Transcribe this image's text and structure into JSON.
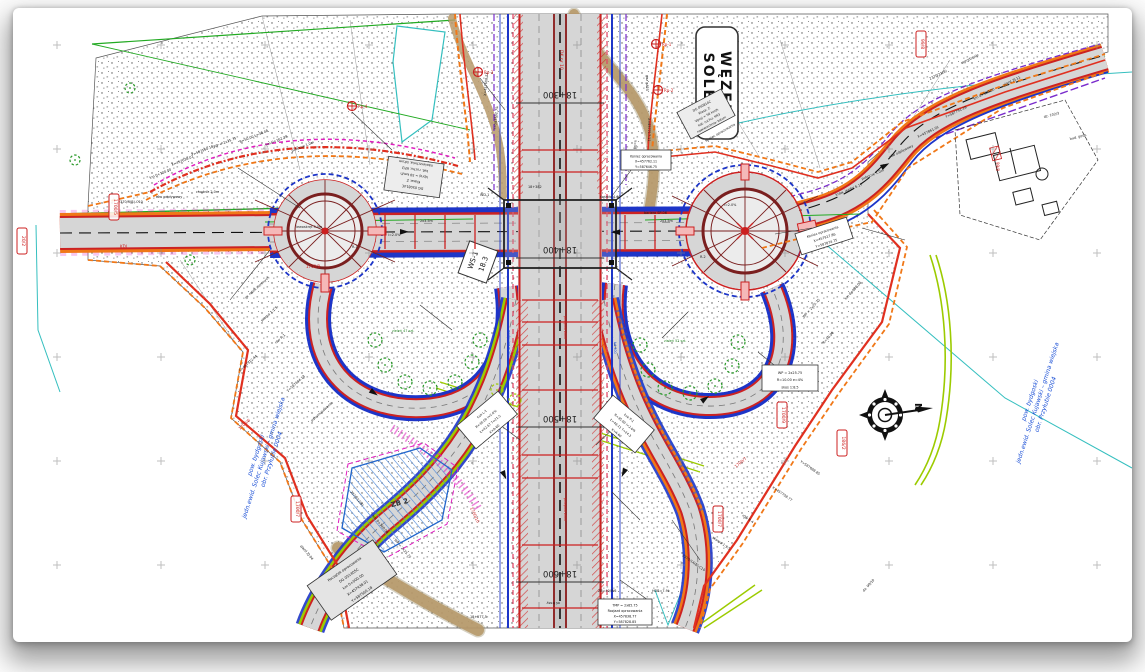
{
  "sheet": {
    "title_box": {
      "line1": "WĘZEŁ",
      "line2": "SOLEC"
    },
    "compass": {
      "label": "N"
    },
    "structure_label": {
      "line1": "WS-1",
      "line2": "18.3"
    },
    "basin_label": "ZB 2",
    "cadastral": {
      "line1": "pow. bydgoski",
      "line2": "jedn.ewid. Solec Kujawski – gmina wiejska",
      "line3": "obr. Przyłubie 0004"
    }
  },
  "colors": {
    "road": "#d6d6d6",
    "road_edge": "#cc2222",
    "roundabout": "#7a1f1f",
    "utility_blue": "#1d35c8",
    "boundary_orange": "#f07818",
    "works_red": "#e03020",
    "property_green": "#22aa22",
    "cadastral_cyan": "#35bfbf",
    "existing_tan": "#b7996a",
    "row_magenta": "#e020c0",
    "lime": "#9ccb00",
    "label": "#1a1a1a",
    "red_label": "#cc2020",
    "blue_label": "#1a4fd6",
    "green_label": "#2a8a2a"
  },
  "chainage": [
    {
      "label": "18+300",
      "x": 560,
      "y": 103
    },
    {
      "label": "18+400",
      "x": 560,
      "y": 258
    },
    {
      "label": "18+500",
      "x": 560,
      "y": 427
    },
    {
      "label": "18+600",
      "x": 560,
      "y": 582
    }
  ],
  "info_boxes": [
    {
      "x": 414,
      "y": 177,
      "w": 56,
      "h": 34,
      "rot": 188,
      "fs": 3.4,
      "fill": "#ededed",
      "lines": [
        "DG 050814C",
        "Klasa: Z",
        "Vproj = 50 km/h",
        "kat. ruchu: KR3",
        "nawierzchnia: bitum"
      ]
    },
    {
      "x": 706,
      "y": 114,
      "w": 50,
      "h": 30,
      "rot": -28,
      "fs": 3.2,
      "fill": "#ededed",
      "lines": [
        "DG 050814C",
        "Klasa: Z",
        "Vproj = 50 km/h",
        "kat. ruchu: KR3",
        "nawierzchnia: bitum"
      ]
    },
    {
      "x": 487,
      "y": 420,
      "w": 54,
      "h": 30,
      "rot": -40,
      "fs": 3.2,
      "fill": "#ffffff",
      "lines": [
        "Łuk L-1",
        "R=30.00  i=2.0%",
        "Ł=42.67  T=21.5",
        "K=A-60"
      ]
    },
    {
      "x": 624,
      "y": 424,
      "w": 54,
      "h": 30,
      "rot": 40,
      "fs": 3.2,
      "fill": "#ffffff",
      "lines": [
        "Łuk P-1",
        "R=35.00  i=2.0%",
        "Ł=48.11  T=24.3",
        "K=A-60"
      ]
    },
    {
      "x": 352,
      "y": 580,
      "w": 80,
      "h": 42,
      "rot": -35,
      "fs": 3.6,
      "fill": "#e4e4e4",
      "lines": [
        "Początek opracowania",
        "DG 051405C",
        "km 0+000.00",
        "X=457438.01",
        "Y=587560.18"
      ]
    },
    {
      "x": 790,
      "y": 378,
      "w": 56,
      "h": 26,
      "rot": 0,
      "fs": 3.4,
      "fill": "#ffffff",
      "lines": [
        "WP = 2x25.75",
        "R=10.00  e=4%",
        "skos 1:8.5"
      ]
    },
    {
      "x": 824,
      "y": 236,
      "w": 54,
      "h": 22,
      "rot": -18,
      "fs": 3.3,
      "fill": "#ffffff",
      "lines": [
        "Koniec opracowania",
        "X=457917.86",
        "Y=587874.75"
      ]
    },
    {
      "x": 646,
      "y": 160,
      "w": 50,
      "h": 20,
      "rot": 0,
      "fs": 3.2,
      "fill": "#ffffff",
      "lines": [
        "Koniec opracowania",
        "X=457762.11",
        "Y=587646.75"
      ]
    },
    {
      "x": 625,
      "y": 612,
      "w": 54,
      "h": 26,
      "rot": 0,
      "fs": 3.3,
      "fill": "#ffffff",
      "lines": [
        "TMP = 2x85.75",
        "Rozjazd opracowania",
        "X=457838.77",
        "Y=587828.85"
      ]
    }
  ],
  "tiny_labels": [
    [
      172,
      166,
      -22,
      "X=457638.01"
    ],
    [
      192,
      156,
      -22,
      "Y=587560.18"
    ],
    [
      214,
      148,
      -22,
      "WP = 2x35.75"
    ],
    [
      240,
      143,
      -22,
      "R=50.00 Ł=38.48"
    ],
    [
      266,
      146,
      -22,
      "hm 0+162.39"
    ],
    [
      292,
      152,
      -22,
      "pobocze 1.0m"
    ],
    [
      150,
      179,
      -22,
      "km 0+120.00"
    ],
    [
      118,
      203,
      0,
      "2370/3(B)-C10"
    ],
    [
      156,
      198,
      0,
      "rów odpływowy"
    ],
    [
      196,
      193,
      0,
      "chodnik 2.0m"
    ],
    [
      246,
      299,
      -42,
      "gr. robót ziemnych"
    ],
    [
      262,
      322,
      -42,
      "skarpa 1:1.5"
    ],
    [
      276,
      344,
      -42,
      "rów R-1"
    ],
    [
      240,
      372,
      -42,
      "X=457512.44"
    ],
    [
      288,
      392,
      -42,
      "Y=587604.18"
    ],
    [
      312,
      422,
      -42,
      "odhumusowanie"
    ],
    [
      350,
      492,
      50,
      "2370/12(B)"
    ],
    [
      372,
      516,
      50,
      "km 0+340.00"
    ],
    [
      394,
      540,
      50,
      "WP = 2x25.75"
    ],
    [
      300,
      546,
      50,
      "zjazd ZJ-04"
    ],
    [
      470,
      618,
      0,
      "18+577.5"
    ],
    [
      560,
      602,
      180,
      "oś trasy"
    ],
    [
      598,
      592,
      0,
      "ZB=40/W6"
    ],
    [
      652,
      592,
      0,
      "HDB=7.9k"
    ],
    [
      682,
      556,
      35,
      "2370/14(B)-C10"
    ],
    [
      712,
      538,
      35,
      "skarpa 1:1.5"
    ],
    [
      742,
      516,
      35,
      "rów R-4"
    ],
    [
      772,
      488,
      35,
      "X=457708.77"
    ],
    [
      800,
      462,
      35,
      "Y=587688.85"
    ],
    [
      804,
      318,
      -48,
      "WP = 2x25.75"
    ],
    [
      824,
      344,
      -48,
      "R=10.00"
    ],
    [
      846,
      300,
      -48,
      "km 0+080.00"
    ],
    [
      836,
      196,
      -22,
      "kraw. jezdni 6.17"
    ],
    [
      862,
      180,
      -22,
      "pobocze 1.0m"
    ],
    [
      890,
      158,
      -26,
      "rów odpływowy"
    ],
    [
      918,
      138,
      -26,
      "X=457861.01"
    ],
    [
      946,
      118,
      -26,
      "Y=587791.18"
    ],
    [
      974,
      100,
      -26,
      "km 0+520.00"
    ],
    [
      1004,
      86,
      -26,
      "zjazd ZJ-11"
    ],
    [
      930,
      80,
      -26,
      "2370/21(B)"
    ],
    [
      962,
      64,
      -26,
      "ogrodzenie"
    ],
    [
      706,
      142,
      -30,
      "Koniec opracowania"
    ],
    [
      648,
      118,
      90,
      "X=457717.11"
    ],
    [
      634,
      140,
      90,
      "Y=587646.71"
    ],
    [
      480,
      196,
      0,
      "WD-1"
    ],
    [
      528,
      188,
      0,
      "18+382"
    ],
    [
      600,
      198,
      0,
      "światło 4.60"
    ],
    [
      644,
      214,
      0,
      "bariera SP-06"
    ],
    [
      352,
      248,
      0,
      "R-1"
    ],
    [
      388,
      236,
      0,
      "i=2.0%"
    ],
    [
      700,
      258,
      0,
      "R-2"
    ],
    [
      724,
      206,
      0,
      "i=2.0%"
    ],
    [
      486,
      96,
      -85,
      "X=457608.13"
    ],
    [
      496,
      130,
      -85,
      "Y=587582.75"
    ],
    [
      646,
      75,
      90,
      "gaz gA25"
    ],
    [
      508,
      330,
      90,
      "wodociąg w160",
      "b"
    ],
    [
      614,
      342,
      90,
      "kd 300",
      "b"
    ],
    [
      392,
      332,
      0,
      "zieleń 47 szt.",
      "g"
    ],
    [
      664,
      342,
      0,
      "zieleń 52 szt.",
      "g"
    ],
    [
      296,
      228,
      0,
      "lewoskręt 3.0m"
    ],
    [
      420,
      222,
      0,
      "2x3.5m"
    ],
    [
      660,
      222,
      0,
      "2x3.5m"
    ],
    [
      1044,
      118,
      -14,
      "dz. 102/3"
    ],
    [
      1070,
      140,
      -14,
      "bud. gosp."
    ],
    [
      864,
      592,
      -48,
      "dz. 99/10"
    ],
    [
      120,
      248,
      0,
      "KDL",
      "r",
      4
    ],
    [
      306,
      268,
      0,
      "1700/8",
      "r",
      4
    ],
    [
      470,
      508,
      65,
      "1700/10",
      "r",
      4
    ],
    [
      736,
      468,
      -40,
      "1700/7",
      "r",
      4
    ],
    [
      996,
      162,
      90,
      "99/8",
      "r",
      4
    ],
    [
      560,
      50,
      90,
      "DK nr 10",
      "r",
      4.5
    ],
    [
      240,
      430,
      -42,
      "1700/6",
      "r",
      4
    ],
    [
      564,
      316,
      90,
      "przepust ø800",
      "r",
      3.2
    ],
    [
      564,
      498,
      90,
      "przepust ø600",
      "r",
      3.2
    ]
  ],
  "parcel_stamps": [
    [
      114,
      196,
      "1700/5"
    ],
    [
      22,
      230,
      "20/2"
    ],
    [
      296,
      498,
      "1700/7"
    ],
    [
      718,
      508,
      "1700/7"
    ],
    [
      842,
      432,
      "186/2"
    ],
    [
      921,
      33,
      "99/8"
    ],
    [
      782,
      404,
      "1700/9"
    ]
  ],
  "survey_points": [
    [
      352,
      106,
      "Rp-4"
    ],
    [
      478,
      72,
      "Rp-3"
    ],
    [
      656,
      44,
      "Rp-1"
    ],
    [
      658,
      90,
      "Rp-2"
    ]
  ],
  "trees": [
    [
      375,
      340,
      7,
      "#2a9a2a"
    ],
    [
      385,
      365,
      7,
      "#2a9a2a"
    ],
    [
      405,
      382,
      7,
      "#2a9a2a"
    ],
    [
      430,
      388,
      7,
      "#2a9a2a"
    ],
    [
      455,
      382,
      7,
      "#2a9a2a"
    ],
    [
      472,
      362,
      7,
      "#2a9a2a"
    ],
    [
      480,
      340,
      7,
      "#2a9a2a"
    ],
    [
      640,
      345,
      7,
      "#2a9a2a"
    ],
    [
      648,
      370,
      7,
      "#2a9a2a"
    ],
    [
      665,
      388,
      7,
      "#2a9a2a"
    ],
    [
      690,
      393,
      7,
      "#2a9a2a"
    ],
    [
      715,
      386,
      7,
      "#2a9a2a"
    ],
    [
      732,
      366,
      7,
      "#2a9a2a"
    ],
    [
      738,
      342,
      7,
      "#2a9a2a"
    ],
    [
      497,
      390,
      6,
      "#9ccb00"
    ],
    [
      515,
      400,
      6,
      "#9ccb00"
    ],
    [
      130,
      88,
      5,
      "#2a9a2a"
    ],
    [
      190,
      260,
      5,
      "#2a9a2a"
    ],
    [
      75,
      160,
      5,
      "#2a9a2a"
    ]
  ],
  "direction_arrows": [
    [
      400,
      229,
      0
    ],
    [
      620,
      235,
      180
    ],
    [
      372,
      388,
      35
    ],
    [
      700,
      399,
      -35
    ],
    [
      505,
      470,
      65
    ],
    [
      628,
      470,
      115
    ],
    [
      880,
      165,
      -28
    ]
  ],
  "road_cross_ticks_v": [
    150,
    172,
    300,
    322,
    345,
    390,
    455,
    478,
    545,
    608
  ],
  "road_cross_ticks_h": [
    385,
    415,
    445,
    475,
    625,
    655
  ],
  "leaders": [
    [
      238,
      168,
      300,
      208
    ],
    [
      640,
      158,
      612,
      196
    ],
    [
      812,
      228,
      775,
      234
    ],
    [
      487,
      415,
      520,
      440
    ],
    [
      622,
      420,
      596,
      445
    ],
    [
      640,
      520,
      612,
      492
    ],
    [
      345,
      572,
      380,
      545
    ],
    [
      700,
      560,
      672,
      520
    ],
    [
      230,
      300,
      270,
      250
    ],
    [
      905,
      240,
      862,
      228
    ],
    [
      648,
      600,
      620,
      580
    ],
    [
      420,
      305,
      452,
      330
    ],
    [
      688,
      312,
      662,
      338
    ],
    [
      790,
      378,
      758,
      352
    ],
    [
      352,
      112,
      392,
      150
    ],
    [
      480,
      78,
      505,
      110
    ]
  ],
  "survey_grid": {
    "x0": 57,
    "y0": 45,
    "dx": 104,
    "dy": 104,
    "nx": 11,
    "ny": 6
  }
}
